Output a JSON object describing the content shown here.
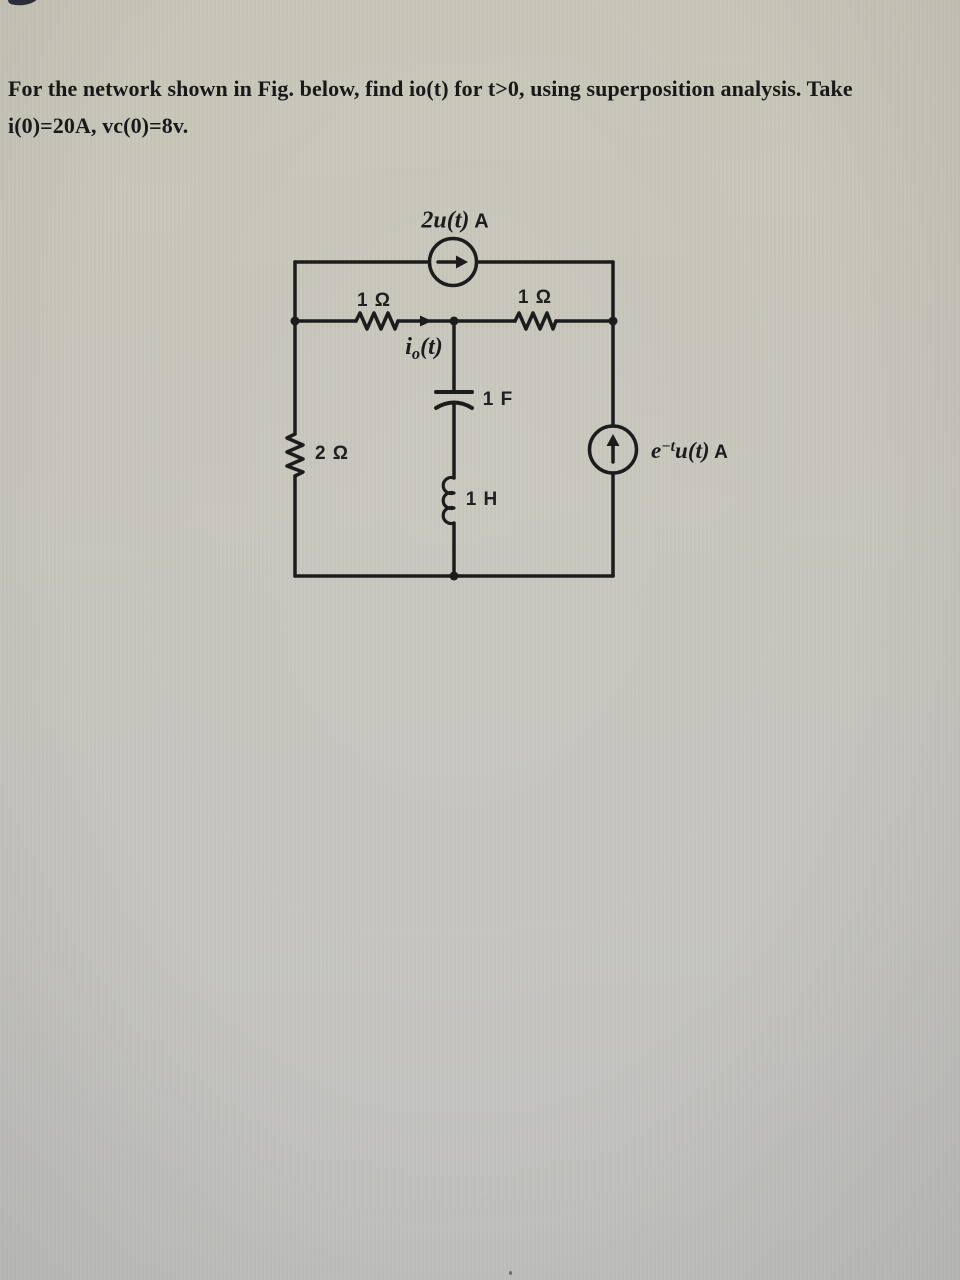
{
  "problem": {
    "line1": "For the network shown in Fig. below, find io(t) for t>0, using superposition analysis. Take",
    "line2": "i(0)=20A, vc(0)=8v."
  },
  "circuit": {
    "top_source": {
      "value": "2u(t)",
      "unit": "A"
    },
    "resistor_top_left": "1 Ω",
    "resistor_top_right": "1 Ω",
    "output_current": {
      "base": "i",
      "sub": "o",
      "rest": "(t)"
    },
    "capacitor": "1 F",
    "resistor_left": "2 Ω",
    "inductor": "1 H",
    "right_source": {
      "base": "e",
      "sup": "−t",
      "rest": "u(t)",
      "unit": "A"
    }
  },
  "colors": {
    "paper_top": "#c9c6b9",
    "paper_bottom": "#c2c2c0",
    "ink": "#1c1c1c"
  }
}
